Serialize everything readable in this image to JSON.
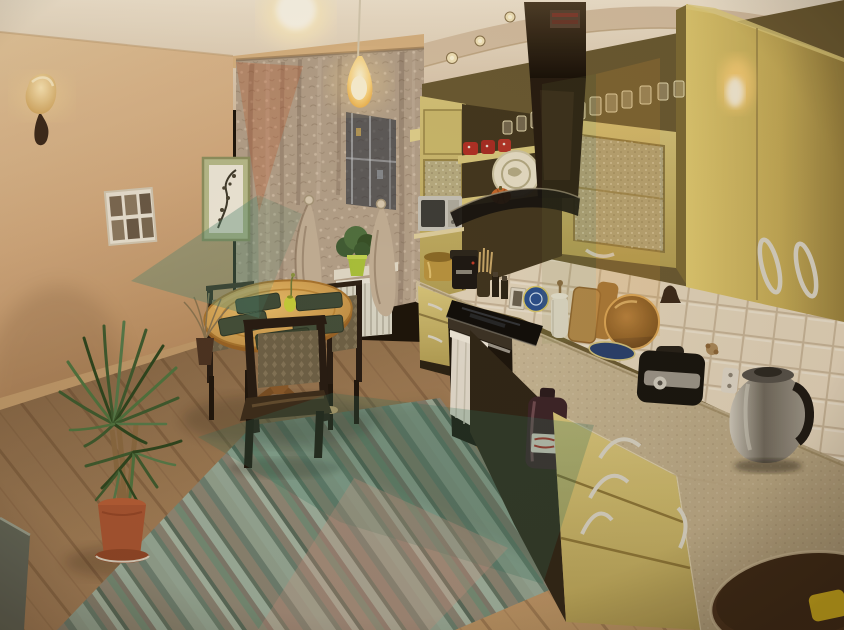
{
  "meta": {
    "type": "photograph",
    "subject": "Kitchen interior with olive-yellow cabinets, dining table and striped rug, evening lighting",
    "width_px": 844,
    "height_px": 630,
    "camera": "wide-angle from doorway corner"
  },
  "palette": {
    "ceiling": "#ecdfca",
    "ceilingShadow": "#d5bfa3",
    "wall": "#dcb88e",
    "wallDeep": "#b98e62",
    "cabinet": "#c9b668",
    "cabinetLight": "#e9d895",
    "cabinetDark": "#8e7a42",
    "hood": "#21180f",
    "tile": "#e2d4bc",
    "grout": "#c6b499",
    "counter": "#c6b594",
    "floor": "#9a7850",
    "floorLight": "#bb9565",
    "rugBase": "#8d8a7b",
    "rugTeal": "#7e9a8a",
    "rugTan": "#9a8d7d",
    "table": "#d8a55c",
    "chairWood": "#241a12",
    "upholstery": "#6e6148",
    "placemat": "#3e4a38",
    "curtain": "#b5a28c",
    "curtainLight": "#cdbda8",
    "windowDark": "#232b3a",
    "radiator": "#dcd8ca",
    "plantGreen": "#3d5a30",
    "potTerracotta": "#a85432",
    "kettleSteel": "#8f8a7e",
    "towel": "#e4ddd0",
    "spongeYellow": "#ddba1f",
    "lampGlow": "#ffdf9e",
    "watermarkTeal": "#4e8a74",
    "watermarkOrange": "#c25a2e",
    "watermarkPink": "#cf9486",
    "watermarkAmber": "#eaa33c"
  },
  "scene": {
    "lighting": [
      "ceiling flush light glowing",
      "amber pendant lamp over table",
      "4 recessed soffit spotlights",
      "amber wall sconce on left wall"
    ],
    "left_wall": [
      "wall sconce",
      "white collage frame with 6 photos",
      "framed oriental branch artwork"
    ],
    "window_area": [
      "patterned sheer curtains gathered in two swags",
      "dark night window with building lights",
      "potted plants on windowsill",
      "white radiator below window"
    ],
    "dining_set": [
      "oval light-wood pedestal table",
      "4 dark-green placemats",
      "small yellow vase with flower",
      "three dark wood chairs with damask upholstery"
    ],
    "kitchen_run": [
      "olive-yellow glossy cabinets with frosted glass doors",
      "row of glasses on top of cabinets",
      "black chimney range hood with curved glass",
      "decorative plate and small pumpkin on shelf",
      "red cups on open shelf",
      "silver microwave on bracket shelf"
    ],
    "countertop_items": [
      "gold multicooker",
      "black coffee machine",
      "utensil holder",
      "spice bottles",
      "standing blue plate",
      "paper towel holder",
      "cutting boards",
      "copper tray",
      "blue oval plate",
      "black multicooker with steel band",
      "stainless electric kettle",
      "wall outlet"
    ],
    "base_units": [
      "base cabinet with towel on oven handle",
      "black glass cooktop",
      "19L water bottle under counter",
      "three-drawer unit with bow handles",
      "corner sink countertop with oval basin",
      "yellow sponge in sink corner"
    ],
    "floor_area": [
      "diagonal striped rug in sage, teal and tan",
      "light oak laminate floor",
      "dracaena houseplant in terracotta pot",
      "dried twigs in small vase",
      "grey radiator edge at far left"
    ],
    "watermark": "translucent geometric triangles (teal on wall, orange on curtain, amber band on cabinets, teal and pink on rug)"
  }
}
